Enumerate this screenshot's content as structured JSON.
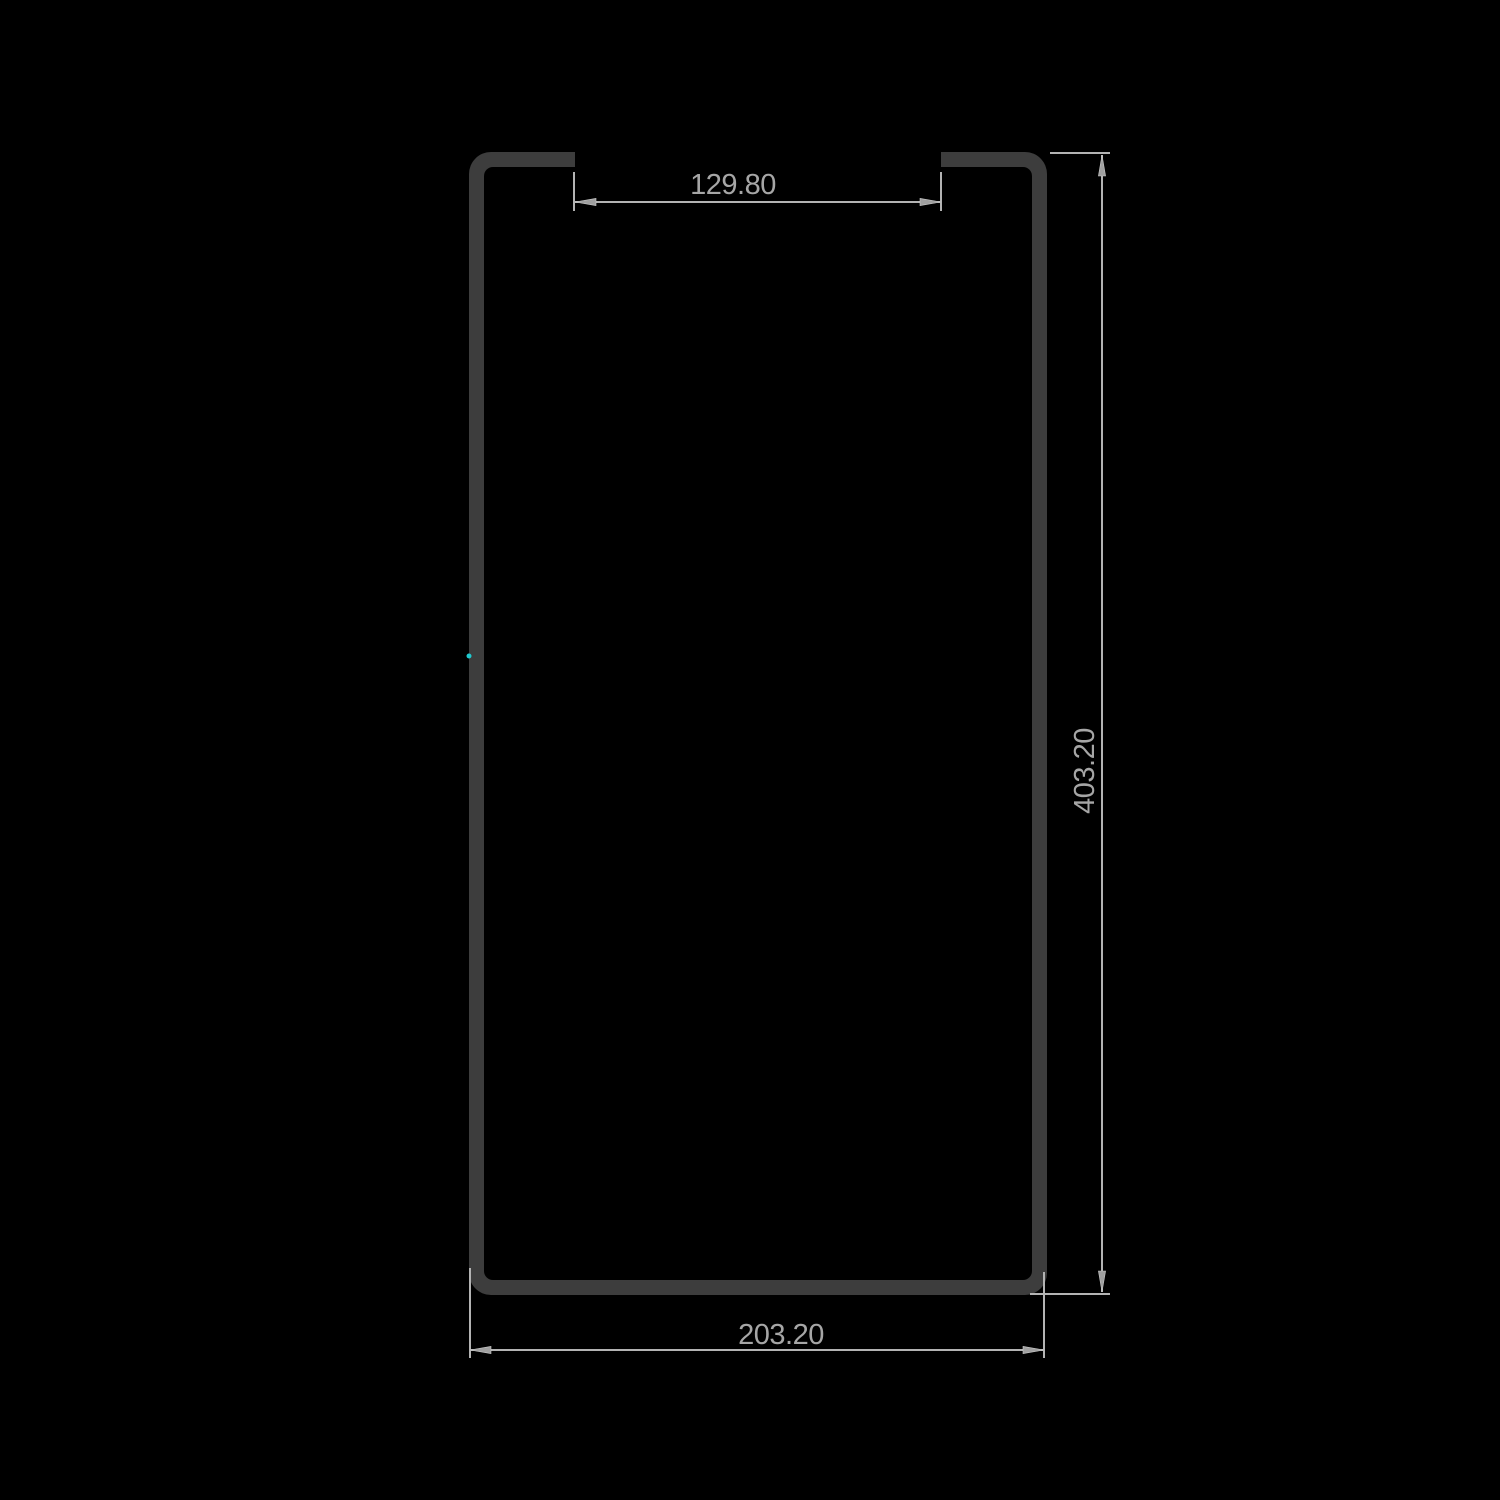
{
  "drawing": {
    "type": "technical-cross-section",
    "part": "slotted rectangular channel profile",
    "dimensions": {
      "slot_width": {
        "value": "129.80"
      },
      "overall_height": {
        "value": "403.20"
      },
      "overall_width": {
        "value": "203.20"
      }
    },
    "colors": {
      "background": "#000000",
      "profile": "#3d3d3d",
      "dimension_line": "#b3b3b3",
      "dimension_text": "#a6a6a6",
      "arrow_fill": "#a0a0a0",
      "vertex_marker": "#1fc9cf"
    }
  }
}
